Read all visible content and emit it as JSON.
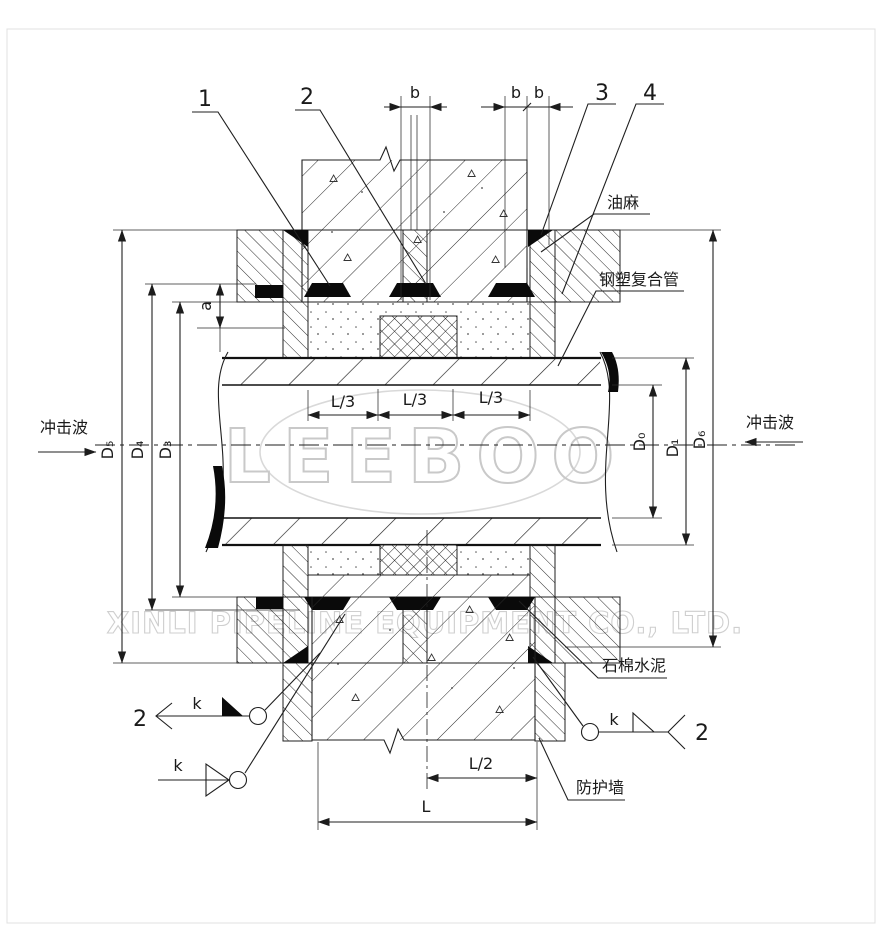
{
  "page": {
    "background": "#ffffff",
    "line_color": "#1f1f1f",
    "watermark_color": "#c9c9c9"
  },
  "callouts": {
    "c1": "1",
    "c2": "2",
    "c3": "3",
    "c4": "4"
  },
  "parts": {
    "oakum": "油麻",
    "pipe": "钢塑复合管",
    "cement": "石棉水泥",
    "wall": "防护墙"
  },
  "shock_wave": "冲击波",
  "dims": {
    "b": "b",
    "a": "a",
    "l3": "L/3",
    "l2": "L/2",
    "l": "L",
    "d0": "D₀",
    "d1": "D₁",
    "d3": "D₃",
    "d4": "D₄",
    "d5": "D₅",
    "d6": "D₆"
  },
  "weld": {
    "k": "k",
    "section": "2"
  },
  "watermark": {
    "logo": "LEEBOO",
    "company": "XINLI PIPELINE EQUIPMENT CO., LTD."
  }
}
